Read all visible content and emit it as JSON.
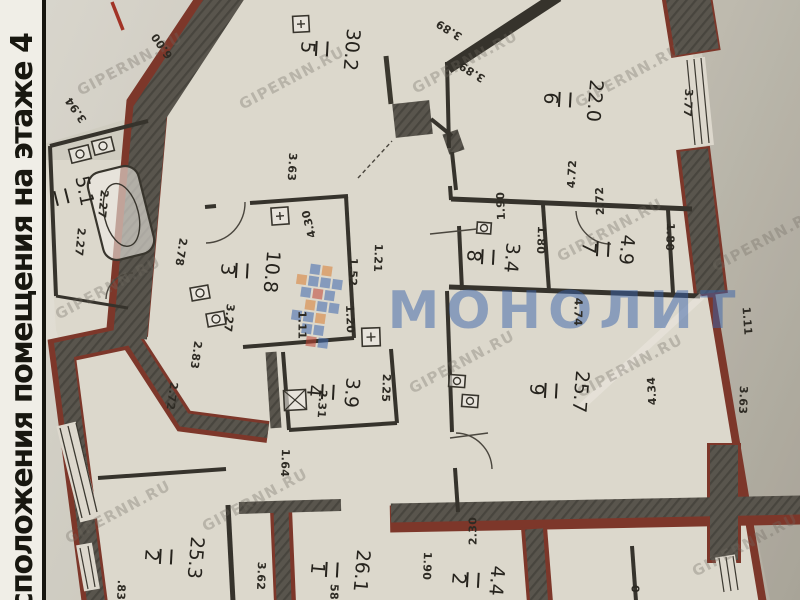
{
  "sidebar": {
    "title": "сположения помещения на этаже 4"
  },
  "watermark": {
    "site": "GIPERNN.RU",
    "brand": "МОНОЛИТ"
  },
  "colors": {
    "paper": "#d8d4c9",
    "wall_dark": "#59554d",
    "wall_red": "#7d372a",
    "brand_blue": "#3f69b0",
    "mosaic_orange": "#da7e33",
    "mosaic_red": "#c04434"
  },
  "rooms": [
    {
      "n": "5",
      "a": "30.2"
    },
    {
      "n": "6",
      "a": "22.0"
    },
    {
      "n": "",
      "a": "5.1"
    },
    {
      "n": "3",
      "a": "10.8"
    },
    {
      "n": "4",
      "a": "3.9"
    },
    {
      "n": "8",
      "a": "3.4"
    },
    {
      "n": "7",
      "a": "4.9"
    },
    {
      "n": "9",
      "a": "25.7"
    },
    {
      "n": "2",
      "a": "25.3"
    },
    {
      "n": "1",
      "a": "26.1"
    },
    {
      "n": "2",
      "a": "4.4"
    }
  ],
  "dims": [
    "3.94",
    "6.00",
    "3.89",
    "3.89",
    "3.63",
    "3.77",
    "4.72",
    "2.27",
    "2.27",
    "2.4",
    "2.78",
    "3.27",
    "4.30",
    "1.21",
    "1.52",
    "1.11",
    "1.20",
    "2.83",
    "2.72",
    "2.31",
    "2.25",
    "1.90",
    "2.72",
    "1.80",
    "1.80",
    "4.74",
    "4.34",
    "3.63",
    "1.11",
    "1.64",
    "3.62",
    ".83",
    "58",
    "2.30",
    "1.90",
    "0"
  ]
}
